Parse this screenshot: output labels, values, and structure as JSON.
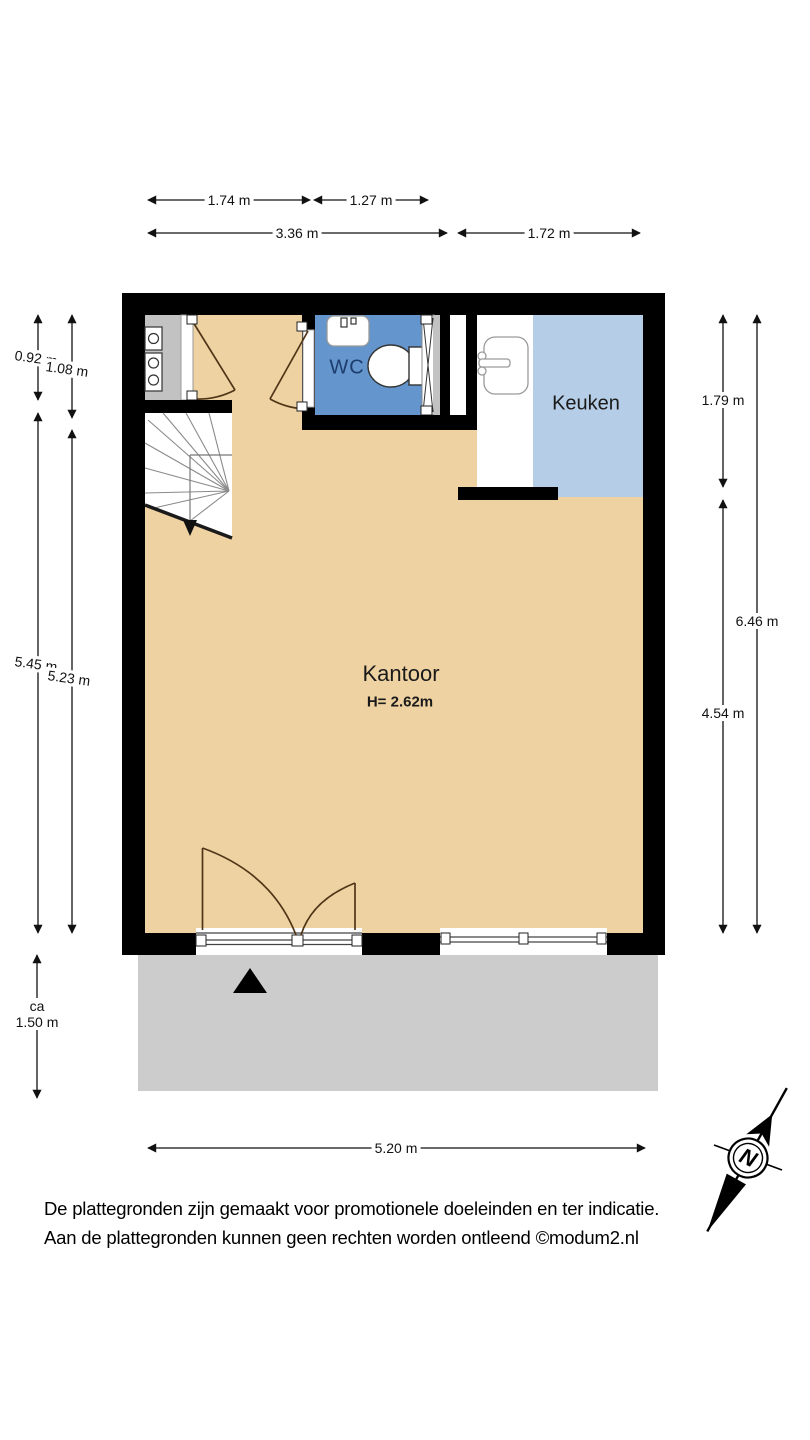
{
  "rooms": [
    {
      "name": "WC"
    },
    {
      "name": "Keuken"
    },
    {
      "name": "Kantoor",
      "ceiling_height": "H= 2.62m"
    }
  ],
  "dimensions": {
    "top": [
      {
        "label": "1.74 m"
      },
      {
        "label": "1.27 m"
      },
      {
        "label": "3.36 m"
      },
      {
        "label": "1.72 m"
      }
    ],
    "left": [
      {
        "label": "0.92 m"
      },
      {
        "label": "1.08 m"
      },
      {
        "label": "5.45 m"
      },
      {
        "label": "5.23 m"
      }
    ],
    "right": [
      {
        "label": "1.79 m"
      },
      {
        "label": "6.46 m"
      },
      {
        "label": "4.54 m"
      }
    ],
    "bottom": [
      {
        "label": "5.20 m"
      }
    ],
    "terrace": {
      "prefix": "ca",
      "label": "1.50 m"
    }
  },
  "compass": {
    "label": "N"
  },
  "footer": {
    "line1": "De plattegronden zijn gemaakt voor promotionele doeleinden en ter indicatie.",
    "line2": "Aan de plattegronden kunnen geen rechten worden ontleend ©modum2.nl"
  },
  "colors": {
    "wall": "#000000",
    "floor": "#eed2a2",
    "wc": "#6495cc",
    "kitchen": "#b6cde8",
    "cupboard": "#c2c2c2",
    "terrace": "#cccccc",
    "door": "#503618",
    "wc_text": "#1d3c6e"
  }
}
